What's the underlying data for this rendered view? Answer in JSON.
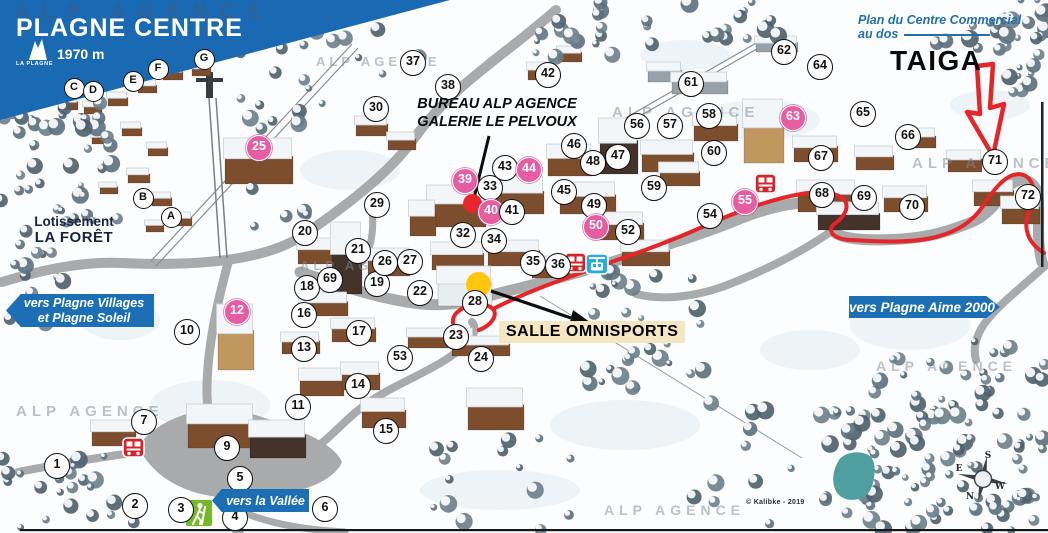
{
  "map": {
    "title": "PLAGNE CENTRE",
    "altitude": "1970 m",
    "logo_label": "LA PLAGNE",
    "watermark_text": "ALP AGENCE",
    "credit": "© Kalibke - 2019",
    "plan_note": {
      "line1": "Plan du Centre Commercial",
      "line2": "au dos"
    },
    "area_labels": {
      "taiga": "TAIGA",
      "bureau_line1": "BUREAU ALP AGENCE",
      "bureau_line2": "GALERIE LE PELVOUX",
      "salle": "SALLE OMNISPORTS",
      "lotissement_line1": "Lotissement",
      "lotissement_line2": "LA FORÊT"
    },
    "direction_banners": {
      "villages": {
        "line1": "vers Plagne Villages",
        "line2": "et Plagne Soleil"
      },
      "aime2000": {
        "line1": "vers Plagne Aime 2000"
      },
      "vallee": {
        "line1": "vers la Vallée"
      }
    },
    "compass": {
      "top": "S",
      "left": "E",
      "right": "W",
      "bottom": "N"
    },
    "colors": {
      "header_blue": "#1a6ab3",
      "banner_blue": "#1c6fb5",
      "pink_marker": "#e75da2",
      "route_red": "#e52528",
      "note_blue": "#2470ad",
      "pond_teal": "#4f9ea0",
      "salle_bg": "#f3e6c1",
      "yellow_dot": "#ffc60b",
      "red_dot": "#e8262a",
      "bus_red": "#d5232a",
      "gondola_blue": "#29abe2",
      "hiker_green": "#76b82a"
    },
    "markers": [
      {
        "n": "1",
        "x": 57,
        "y": 466
      },
      {
        "n": "2",
        "x": 135,
        "y": 506
      },
      {
        "n": "3",
        "x": 181,
        "y": 510
      },
      {
        "n": "4",
        "x": 235,
        "y": 518
      },
      {
        "n": "5",
        "x": 240,
        "y": 479
      },
      {
        "n": "6",
        "x": 325,
        "y": 509
      },
      {
        "n": "7",
        "x": 144,
        "y": 422
      },
      {
        "n": "9",
        "x": 227,
        "y": 448
      },
      {
        "n": "10",
        "x": 187,
        "y": 332
      },
      {
        "n": "11",
        "x": 298,
        "y": 407
      },
      {
        "n": "12",
        "x": 237,
        "y": 312,
        "pink": true
      },
      {
        "n": "13",
        "x": 304,
        "y": 349
      },
      {
        "n": "14",
        "x": 358,
        "y": 386
      },
      {
        "n": "15",
        "x": 386,
        "y": 431
      },
      {
        "n": "16",
        "x": 304,
        "y": 315
      },
      {
        "n": "17",
        "x": 359,
        "y": 333
      },
      {
        "n": "18",
        "x": 307,
        "y": 288
      },
      {
        "n": "19",
        "x": 377,
        "y": 284
      },
      {
        "n": "20",
        "x": 305,
        "y": 233
      },
      {
        "n": "21",
        "x": 358,
        "y": 251
      },
      {
        "n": "22",
        "x": 420,
        "y": 293
      },
      {
        "n": "23",
        "x": 456,
        "y": 337
      },
      {
        "n": "24",
        "x": 481,
        "y": 359
      },
      {
        "n": "25",
        "x": 259,
        "y": 148,
        "pink": true
      },
      {
        "n": "26",
        "x": 385,
        "y": 263
      },
      {
        "n": "27",
        "x": 410,
        "y": 262
      },
      {
        "n": "28",
        "x": 475,
        "y": 303
      },
      {
        "n": "29",
        "x": 377,
        "y": 205
      },
      {
        "n": "30",
        "x": 376,
        "y": 109
      },
      {
        "n": "32",
        "x": 463,
        "y": 235
      },
      {
        "n": "33",
        "x": 490,
        "y": 188
      },
      {
        "n": "34",
        "x": 494,
        "y": 241
      },
      {
        "n": "35",
        "x": 533,
        "y": 263
      },
      {
        "n": "36",
        "x": 558,
        "y": 266
      },
      {
        "n": "37",
        "x": 413,
        "y": 63
      },
      {
        "n": "38",
        "x": 448,
        "y": 87
      },
      {
        "n": "39",
        "x": 465,
        "y": 181,
        "pink": true
      },
      {
        "n": "40",
        "x": 491,
        "y": 212,
        "pink": true
      },
      {
        "n": "41",
        "x": 512,
        "y": 212
      },
      {
        "n": "42",
        "x": 548,
        "y": 75
      },
      {
        "n": "43",
        "x": 505,
        "y": 168
      },
      {
        "n": "44",
        "x": 529,
        "y": 170,
        "pink": true
      },
      {
        "n": "45",
        "x": 564,
        "y": 192
      },
      {
        "n": "46",
        "x": 574,
        "y": 146
      },
      {
        "n": "47",
        "x": 618,
        "y": 157
      },
      {
        "n": "48",
        "x": 593,
        "y": 163
      },
      {
        "n": "49",
        "x": 594,
        "y": 206
      },
      {
        "n": "50",
        "x": 596,
        "y": 227,
        "pink": true
      },
      {
        "n": "52",
        "x": 628,
        "y": 232
      },
      {
        "n": "53",
        "x": 400,
        "y": 358
      },
      {
        "n": "54",
        "x": 710,
        "y": 216
      },
      {
        "n": "55",
        "x": 745,
        "y": 202,
        "pink": true
      },
      {
        "n": "56",
        "x": 637,
        "y": 126
      },
      {
        "n": "57",
        "x": 670,
        "y": 126
      },
      {
        "n": "58",
        "x": 709,
        "y": 116
      },
      {
        "n": "59",
        "x": 654,
        "y": 188
      },
      {
        "n": "60",
        "x": 714,
        "y": 153
      },
      {
        "n": "61",
        "x": 691,
        "y": 84
      },
      {
        "n": "62",
        "x": 784,
        "y": 52
      },
      {
        "n": "63",
        "x": 793,
        "y": 118,
        "pink": true
      },
      {
        "n": "64",
        "x": 820,
        "y": 67
      },
      {
        "n": "65",
        "x": 863,
        "y": 114
      },
      {
        "n": "66",
        "x": 908,
        "y": 137
      },
      {
        "n": "67",
        "x": 821,
        "y": 158
      },
      {
        "n": "68",
        "x": 822,
        "y": 195
      },
      {
        "n": "69",
        "x": 864,
        "y": 198
      },
      {
        "n": "69",
        "x": 330,
        "y": 280
      },
      {
        "n": "70",
        "x": 912,
        "y": 207
      },
      {
        "n": "71",
        "x": 995,
        "y": 162
      },
      {
        "n": "72",
        "x": 1028,
        "y": 197
      }
    ],
    "letter_markers": [
      {
        "n": "A",
        "x": 171,
        "y": 217
      },
      {
        "n": "B",
        "x": 143,
        "y": 198
      },
      {
        "n": "C",
        "x": 74,
        "y": 88
      },
      {
        "n": "D",
        "x": 93,
        "y": 91
      },
      {
        "n": "E",
        "x": 133,
        "y": 81
      },
      {
        "n": "F",
        "x": 158,
        "y": 69
      },
      {
        "n": "G",
        "x": 204,
        "y": 59
      }
    ],
    "icons": [
      {
        "type": "bus-icon",
        "x": 134,
        "y": 448
      },
      {
        "type": "bus-icon",
        "x": 576,
        "y": 263
      },
      {
        "type": "bus-icon",
        "x": 766,
        "y": 184
      },
      {
        "type": "gondola-icon",
        "x": 597,
        "y": 264
      },
      {
        "type": "hiker-icon",
        "x": 199,
        "y": 513
      }
    ],
    "highlight_dots": [
      {
        "name": "red-dot",
        "x": 472,
        "y": 203,
        "size": 19,
        "color": "#e8262a"
      },
      {
        "name": "yellow-dot",
        "x": 478,
        "y": 284,
        "size": 25,
        "color": "#ffc60b"
      }
    ]
  }
}
